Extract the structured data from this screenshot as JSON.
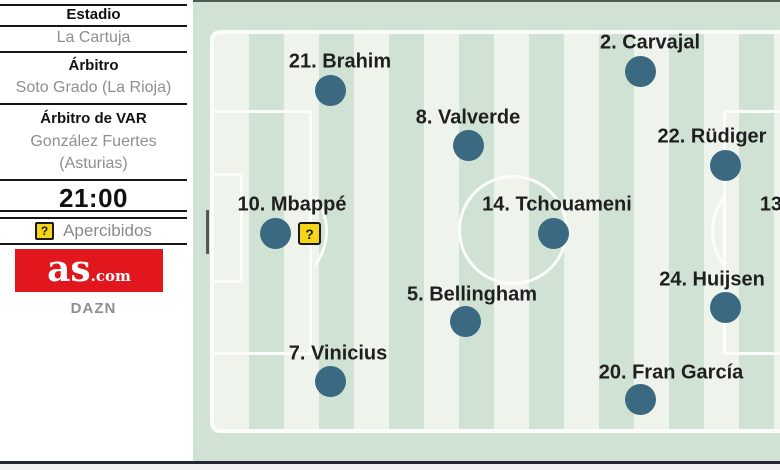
{
  "sidebar": {
    "stadium_label": "Estadio",
    "stadium": "La Cartuja",
    "referee_label": "Árbitro",
    "referee": "Soto Grado (La Rioja)",
    "var_label": "Árbitro de VAR",
    "var_name": "González Fuertes",
    "var_region": "(Asturias)",
    "kickoff_time": "21:00",
    "warning_badge": "?",
    "apercibidos_label": "Apercibidos",
    "logo_main": "as",
    "logo_suffix": ".com",
    "broadcaster": "DAZN"
  },
  "pitch": {
    "players": [
      {
        "label": "21. Brahim",
        "dot": [
          330,
          90
        ],
        "label_pos": [
          340,
          62
        ]
      },
      {
        "label": "2. Carvajal",
        "dot": [
          640,
          71
        ],
        "label_pos": [
          650,
          43
        ]
      },
      {
        "label": "8. Valverde",
        "dot": [
          468,
          145
        ],
        "label_pos": [
          468,
          118
        ]
      },
      {
        "label": "22. Rüdiger",
        "dot": [
          725,
          165
        ],
        "label_pos": [
          712,
          137
        ]
      },
      {
        "label": "10. Mbappé",
        "dot": [
          275,
          233
        ],
        "label_pos": [
          292,
          205
        ],
        "badge": [
          298,
          222
        ],
        "badge_text": "?"
      },
      {
        "label": "14. Tchouameni",
        "dot": [
          553,
          233
        ],
        "label_pos": [
          557,
          205
        ]
      },
      {
        "label": "13",
        "dot": null,
        "label_pos": [
          771,
          205
        ]
      },
      {
        "label": "5. Bellingham",
        "dot": [
          465,
          321
        ],
        "label_pos": [
          472,
          295
        ]
      },
      {
        "label": "24. Huijsen",
        "dot": [
          725,
          307
        ],
        "label_pos": [
          712,
          280
        ]
      },
      {
        "label": "7. Vinicius",
        "dot": [
          330,
          381
        ],
        "label_pos": [
          338,
          354
        ]
      },
      {
        "label": "20. Fran García",
        "dot": [
          640,
          399
        ],
        "label_pos": [
          671,
          373
        ]
      }
    ],
    "colors": {
      "stripe_light": "#eef4ec",
      "stripe_green": "#cfe2d3",
      "line_white": "#fbfdfb",
      "player_dot": "#3b6981",
      "label_text": "#1f1f1f",
      "warning_yellow": "#f4d519",
      "as_red": "#e2161d"
    }
  }
}
